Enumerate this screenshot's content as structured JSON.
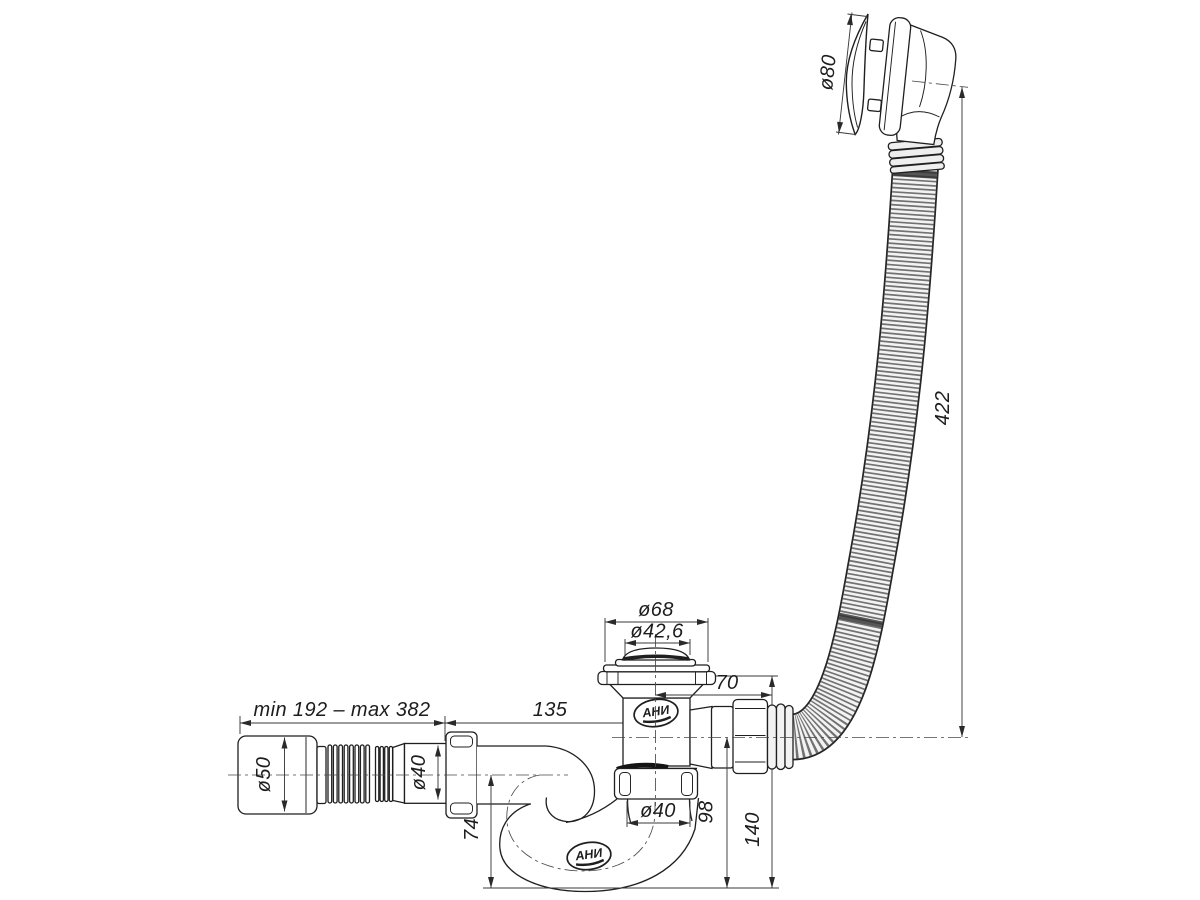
{
  "drawing": {
    "brand_logo": "АНИ",
    "dims": {
      "overflow_cap": "ø80",
      "overflow_hose_length": "422",
      "drain_flange": "ø68",
      "drain_opening": "ø42,6",
      "outlet_offset": "70",
      "inlet_offset": "135",
      "flex_outlet_range": "min 192 – max 382",
      "outlet_end": "ø50",
      "flex_pipe": "ø40",
      "trap_inlet": "ø40",
      "water_seal_depth": "74",
      "outlet_axis_height": "98",
      "installation_height": "140"
    }
  }
}
